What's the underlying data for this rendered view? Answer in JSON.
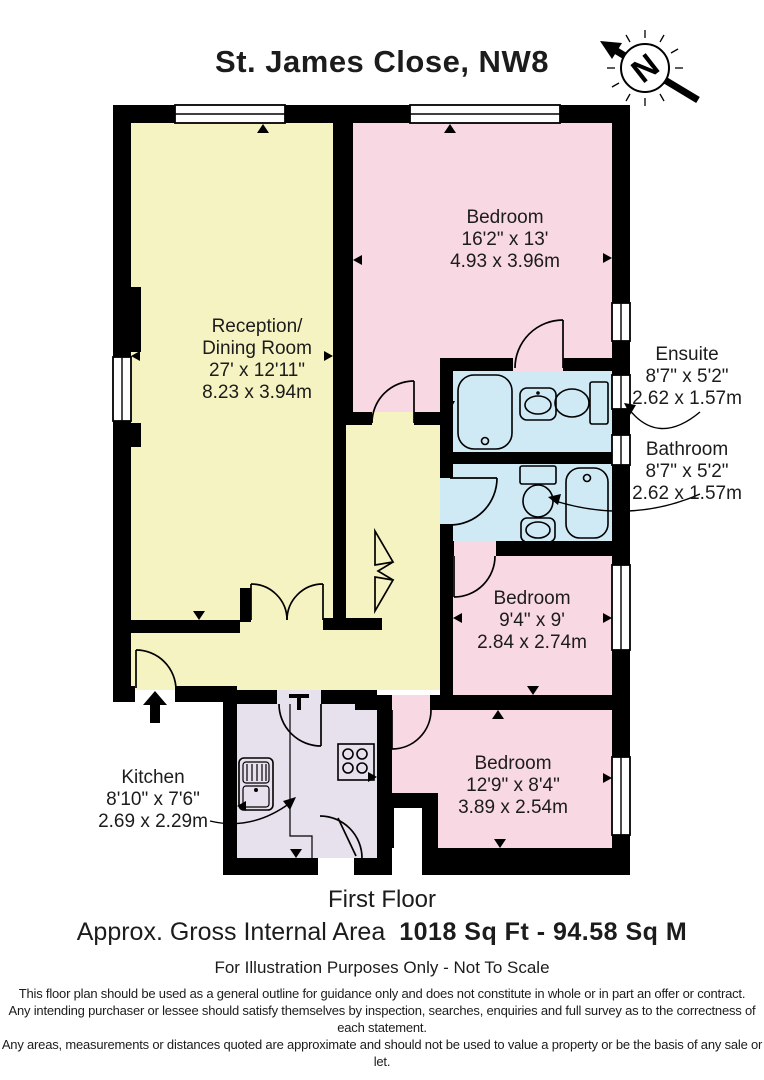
{
  "title": "St. James Close, NW8",
  "compass": {
    "letter": "N"
  },
  "rooms": {
    "reception": {
      "line1": "Reception/",
      "line2": "Dining Room",
      "imperial": "27' x 12'11\"",
      "metric": "8.23 x 3.94m"
    },
    "bedroom1": {
      "name": "Bedroom",
      "imperial": "16'2\" x 13'",
      "metric": "4.93 x 3.96m"
    },
    "ensuite": {
      "name": "Ensuite",
      "imperial": "8'7\" x 5'2\"",
      "metric": "2.62 x 1.57m"
    },
    "bathroom": {
      "name": "Bathroom",
      "imperial": "8'7\" x 5'2\"",
      "metric": "2.62 x 1.57m"
    },
    "bedroom2": {
      "name": "Bedroom",
      "imperial": "9'4\" x 9'",
      "metric": "2.84 x 2.74m"
    },
    "bedroom3": {
      "name": "Bedroom",
      "imperial": "12'9\" x 8'4\"",
      "metric": "3.89 x 2.54m"
    },
    "kitchen": {
      "name": "Kitchen",
      "imperial": "8'10\" x 7'6\"",
      "metric": "2.69 x 2.29m"
    }
  },
  "footer": {
    "floor": "First Floor",
    "area_label": "Approx. Gross Internal Area",
    "area_value": "1018 Sq Ft - 94.58 Sq M",
    "note": "For Illustration Purposes Only - Not To Scale",
    "disclaimer_line1": "This floor plan should be used as a general outline for guidance only and does not constitute in whole or in part an offer or contract.",
    "disclaimer_line2": "Any intending purchaser or lessee should satisfy themselves by inspection, searches, enquiries and full survey as to the correctness of each statement.",
    "disclaimer_line3": "Any areas, measurements or distances quoted are approximate and should not be used to value a property or be the basis of any sale or let."
  },
  "colors": {
    "room_yellow": "#f6f3c2",
    "room_pink": "#f8d8e2",
    "room_blue": "#cfe9f5",
    "room_lavender": "#e7e0ed",
    "wall": "#000000"
  }
}
